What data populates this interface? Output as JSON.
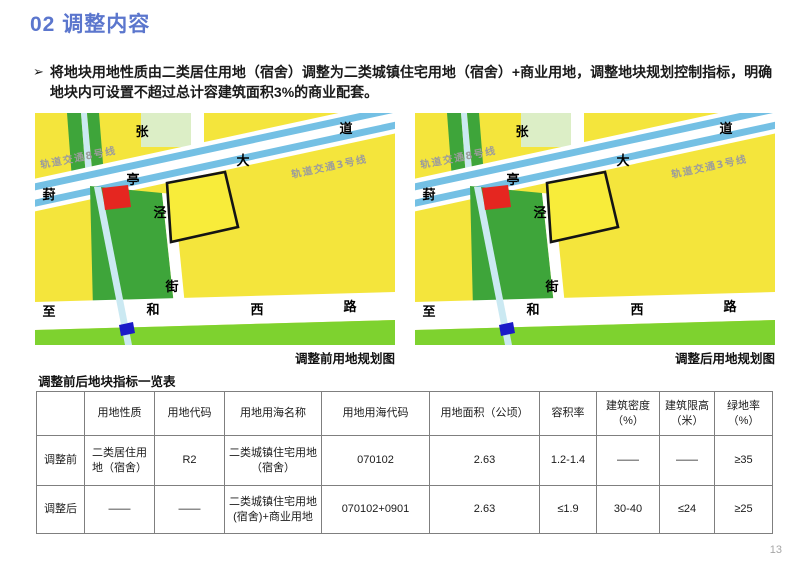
{
  "title": "02 调整内容",
  "bullet": {
    "marker": "➢",
    "text": "将地块用地性质由二类居住用地（宿舍）调整为二类城镇住宅用地（宿舍）+商业用地，调整地块规划控制指标，明确地块内可设置不超过总计容建筑面积3%的商业配套。"
  },
  "maps": {
    "before_caption": "调整前用地规划图",
    "after_caption": "调整后用地规划图",
    "labels": {
      "metro8": "轨道交通8号线",
      "metro3": "轨道交通3号线",
      "n_zhang": "张",
      "n_dao": "道",
      "n_da": "大",
      "n_ting": "亭",
      "n_feng": "葑",
      "n_jing": "泾",
      "n_jie": "街",
      "n_zhi": "至",
      "n_he": "和",
      "n_xi": "西",
      "n_lu": "路"
    },
    "colors": {
      "land_yellow": "#F4E53C",
      "parcel_yellow": "#F8EC3A",
      "park_green": "#3EA53A",
      "lawn_green": "#7ED22F",
      "pale_green": "#DCEEC6",
      "metro_blue": "#74C0E4",
      "stream_blue": "#CBE9F2",
      "parcel_red": "#E52620",
      "marker_blue": "#1B1BC8",
      "parcel_outline": "#141414"
    }
  },
  "table": {
    "title": "调整前后地块指标一览表",
    "headers": [
      "",
      "用地性质",
      "用地代码",
      "用地用海名称",
      "用地用海代码",
      "用地面积（公顷）",
      "容积率",
      "建筑密度（%）",
      "建筑限高（米）",
      "绿地率（%）"
    ],
    "rows": [
      {
        "label": "调整前",
        "cells": [
          "二类居住用地（宿舍）",
          "R2",
          "二类城镇住宅用地（宿舍）",
          "070102",
          "2.63",
          "1.2-1.4",
          "——",
          "——",
          "≥35"
        ]
      },
      {
        "label": "调整后",
        "cells": [
          "——",
          "——",
          "二类城镇住宅用地(宿舍)+商业用地",
          "070102+0901",
          "2.63",
          "≤1.9",
          "30-40",
          "≤24",
          "≥25"
        ]
      }
    ]
  },
  "footer": {
    "page_number": "13"
  },
  "theme": {
    "title_blue": "#5B76CD",
    "text_black": "#1A1A1A",
    "border_gray": "#7F7F7F",
    "page_number_gray": "#A6A6A6"
  }
}
